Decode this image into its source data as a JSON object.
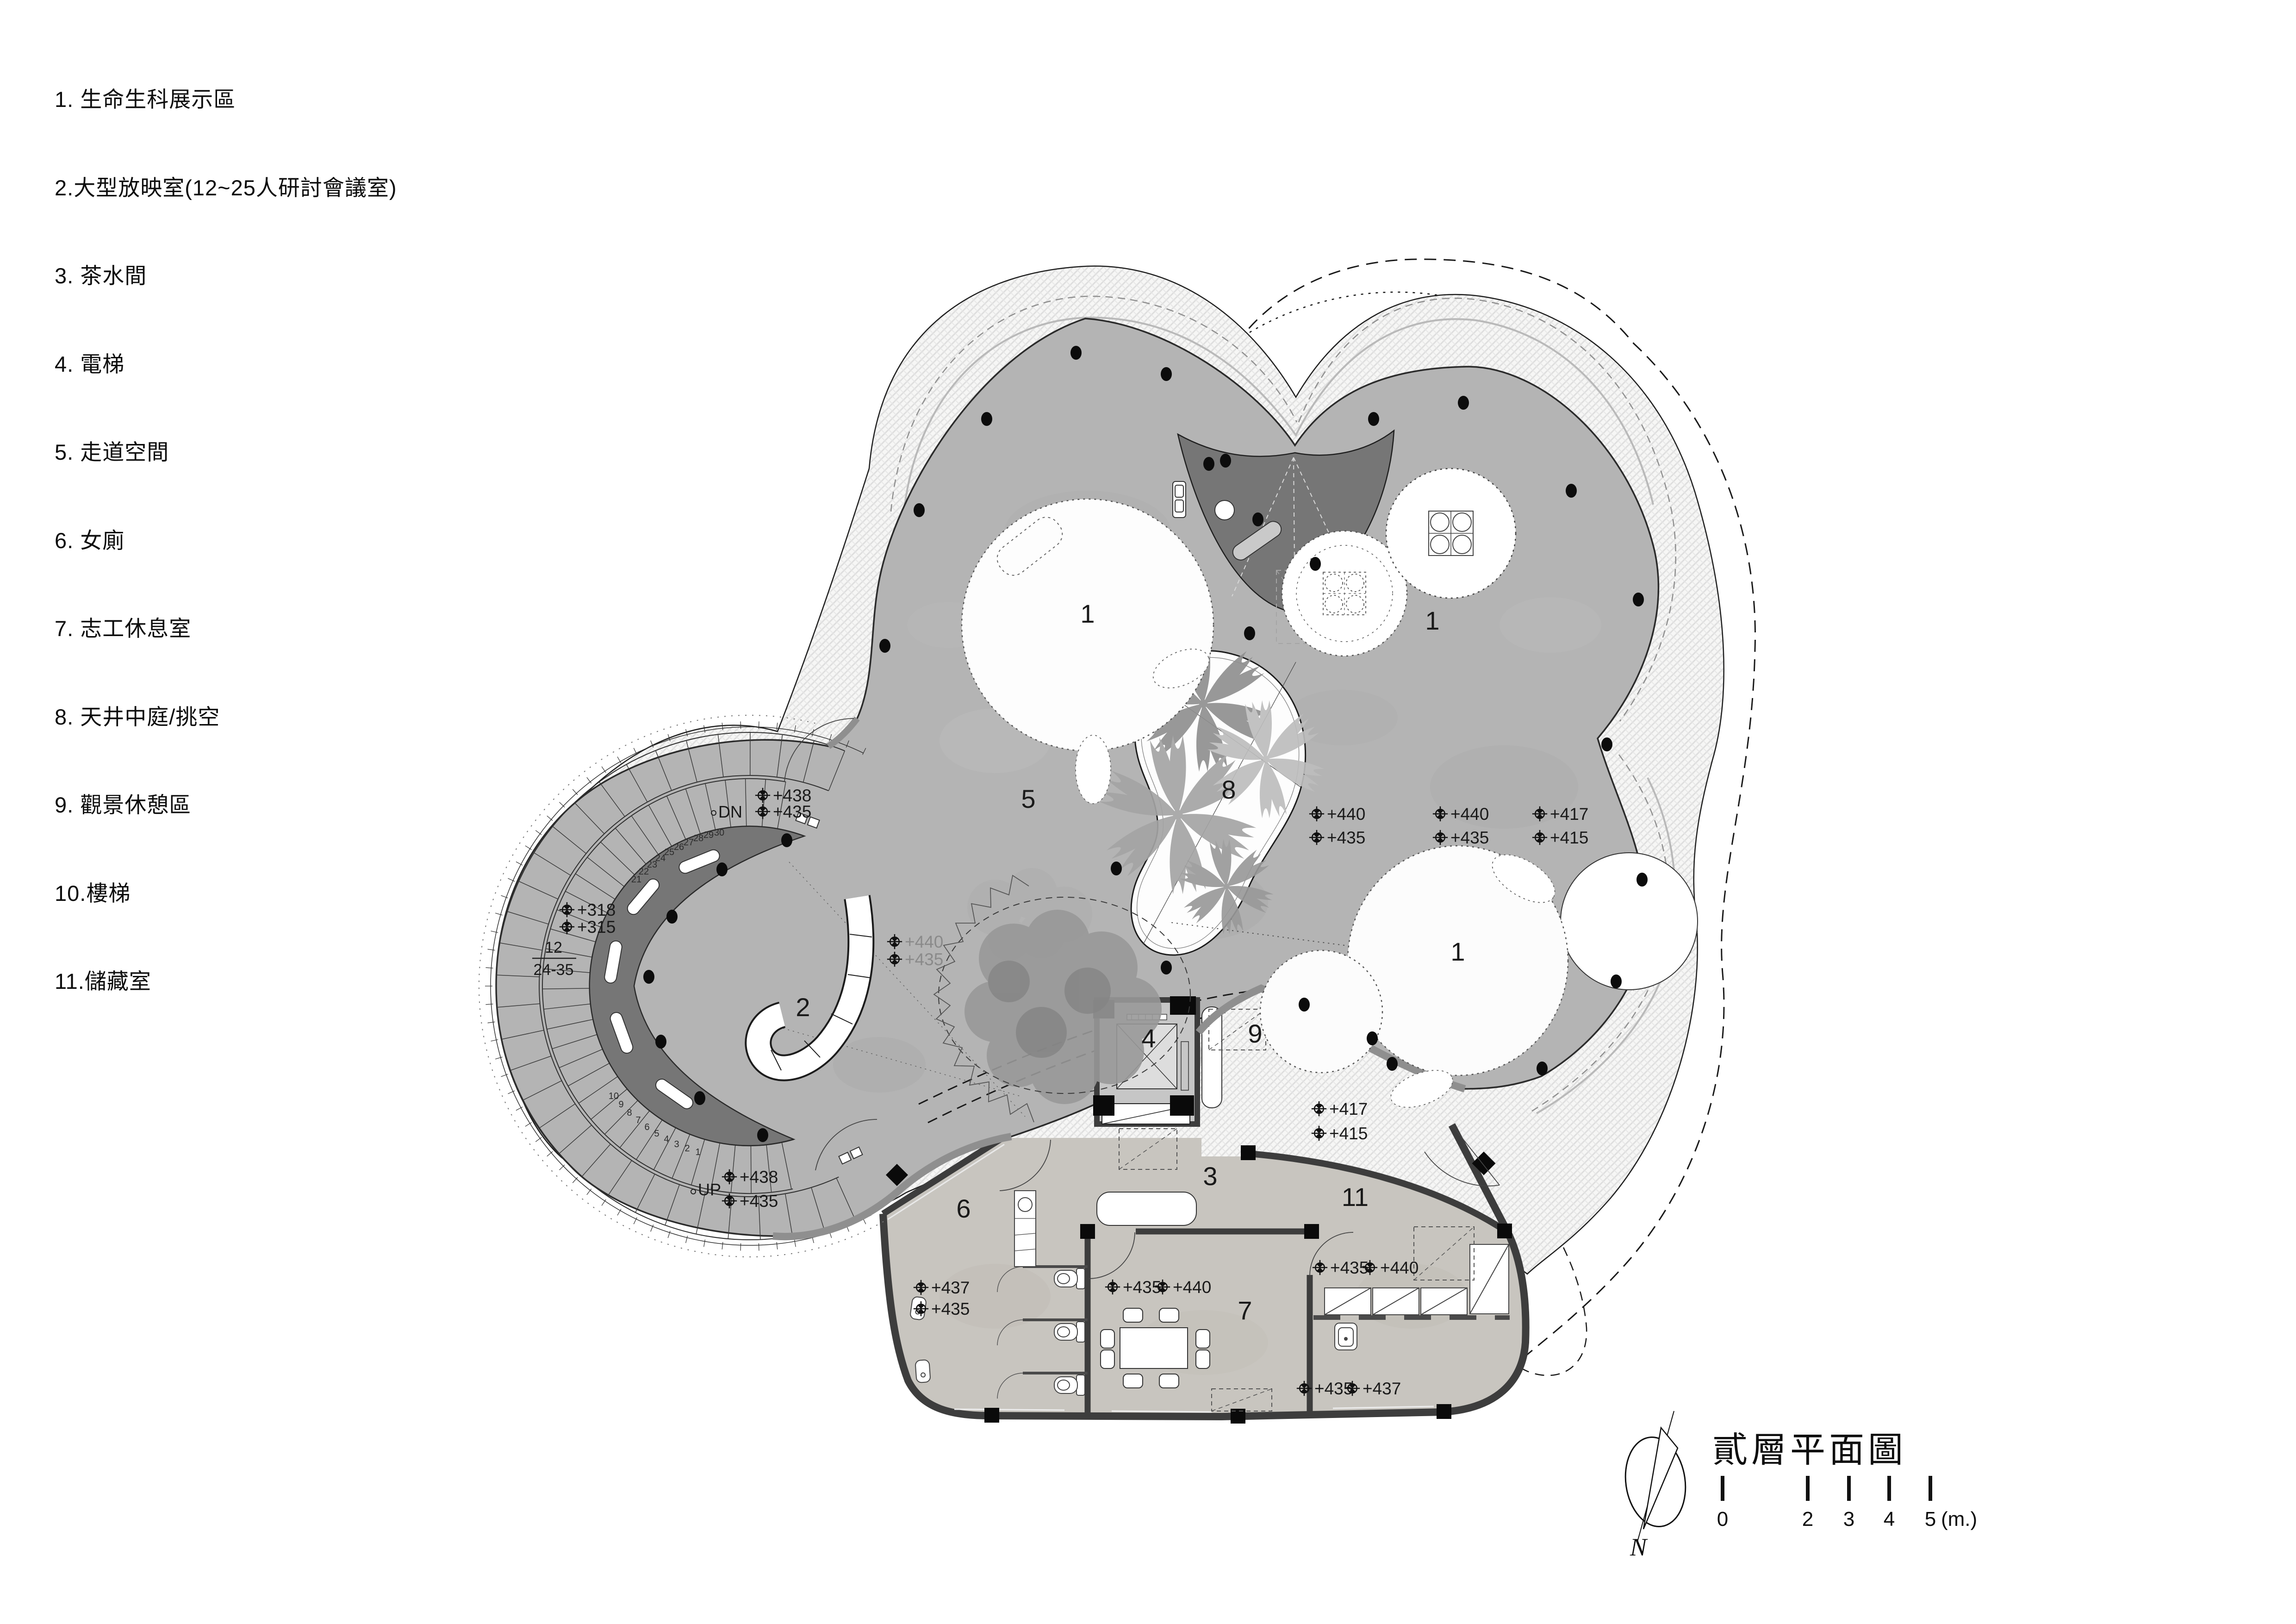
{
  "legend": {
    "items": [
      "1. 生命生科展示區",
      "2.大型放映室(12~25人研討會議室)",
      "3. 茶水間",
      "4. 電梯",
      "5. 走道空間",
      "6. 女廁",
      "7. 志工休息室",
      "8. 天井中庭/挑空",
      "9. 觀景休憩區",
      "10.樓梯",
      "11.儲藏室"
    ]
  },
  "plan": {
    "room_labels": [
      "1",
      "1",
      "1",
      "2",
      "3",
      "4",
      "5",
      "6",
      "7",
      "8",
      "9",
      "11"
    ],
    "markers": [
      "+438",
      "+435",
      "+318",
      "+315",
      "+440",
      "+435",
      "+438",
      "+435",
      "+440",
      "+435",
      "+440",
      "+435",
      "+417",
      "+415",
      "+417",
      "+415",
      "+437",
      "+435",
      "+435",
      "+440",
      "+435",
      "+440",
      "+435",
      "+437"
    ],
    "dn_label": "DN",
    "up_label": "UP",
    "stair_note_upper": "12",
    "stair_note_lower": "24-35",
    "steps_bottom": [
      "1",
      "2",
      "3",
      "4",
      "5",
      "6",
      "7",
      "8",
      "9",
      "10"
    ],
    "steps_top": [
      "21",
      "22",
      "23",
      "24",
      "25",
      "26",
      "27",
      "28",
      "29",
      "30"
    ]
  },
  "titleblock": {
    "title": "貳層平面圖",
    "north_label": "N",
    "scale_labels": [
      "0",
      "2",
      "3",
      "4",
      "5"
    ],
    "scale_unit": "(m.)"
  }
}
